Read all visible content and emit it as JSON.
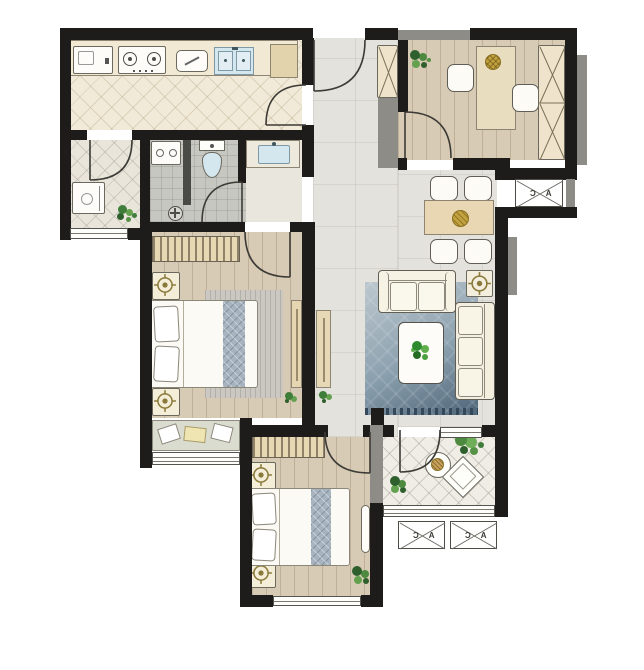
{
  "ac": {
    "label": "A C"
  },
  "colors": {
    "wall": "#1d1c1b",
    "wallGray": "#8d8c86",
    "kitchenFloor": "#f2ead8",
    "utilityFloor": "#e9e5da",
    "balconyFloor": "#efede5",
    "bathFloor": "#c7c7c2",
    "dryFloor": "#e9e6de",
    "hallFloor": "#e4e2dc",
    "woodFloor": "#d8cbb5",
    "beige": "#e9d8b6",
    "wardrobe": "#e7d8b4",
    "rugTop": "#bcc7ce",
    "rugBottom": "#4e6578",
    "sinkBlue": "#d4e6ee",
    "lampGold": "#8a7a3a",
    "plateGold": "#c2a23c"
  }
}
